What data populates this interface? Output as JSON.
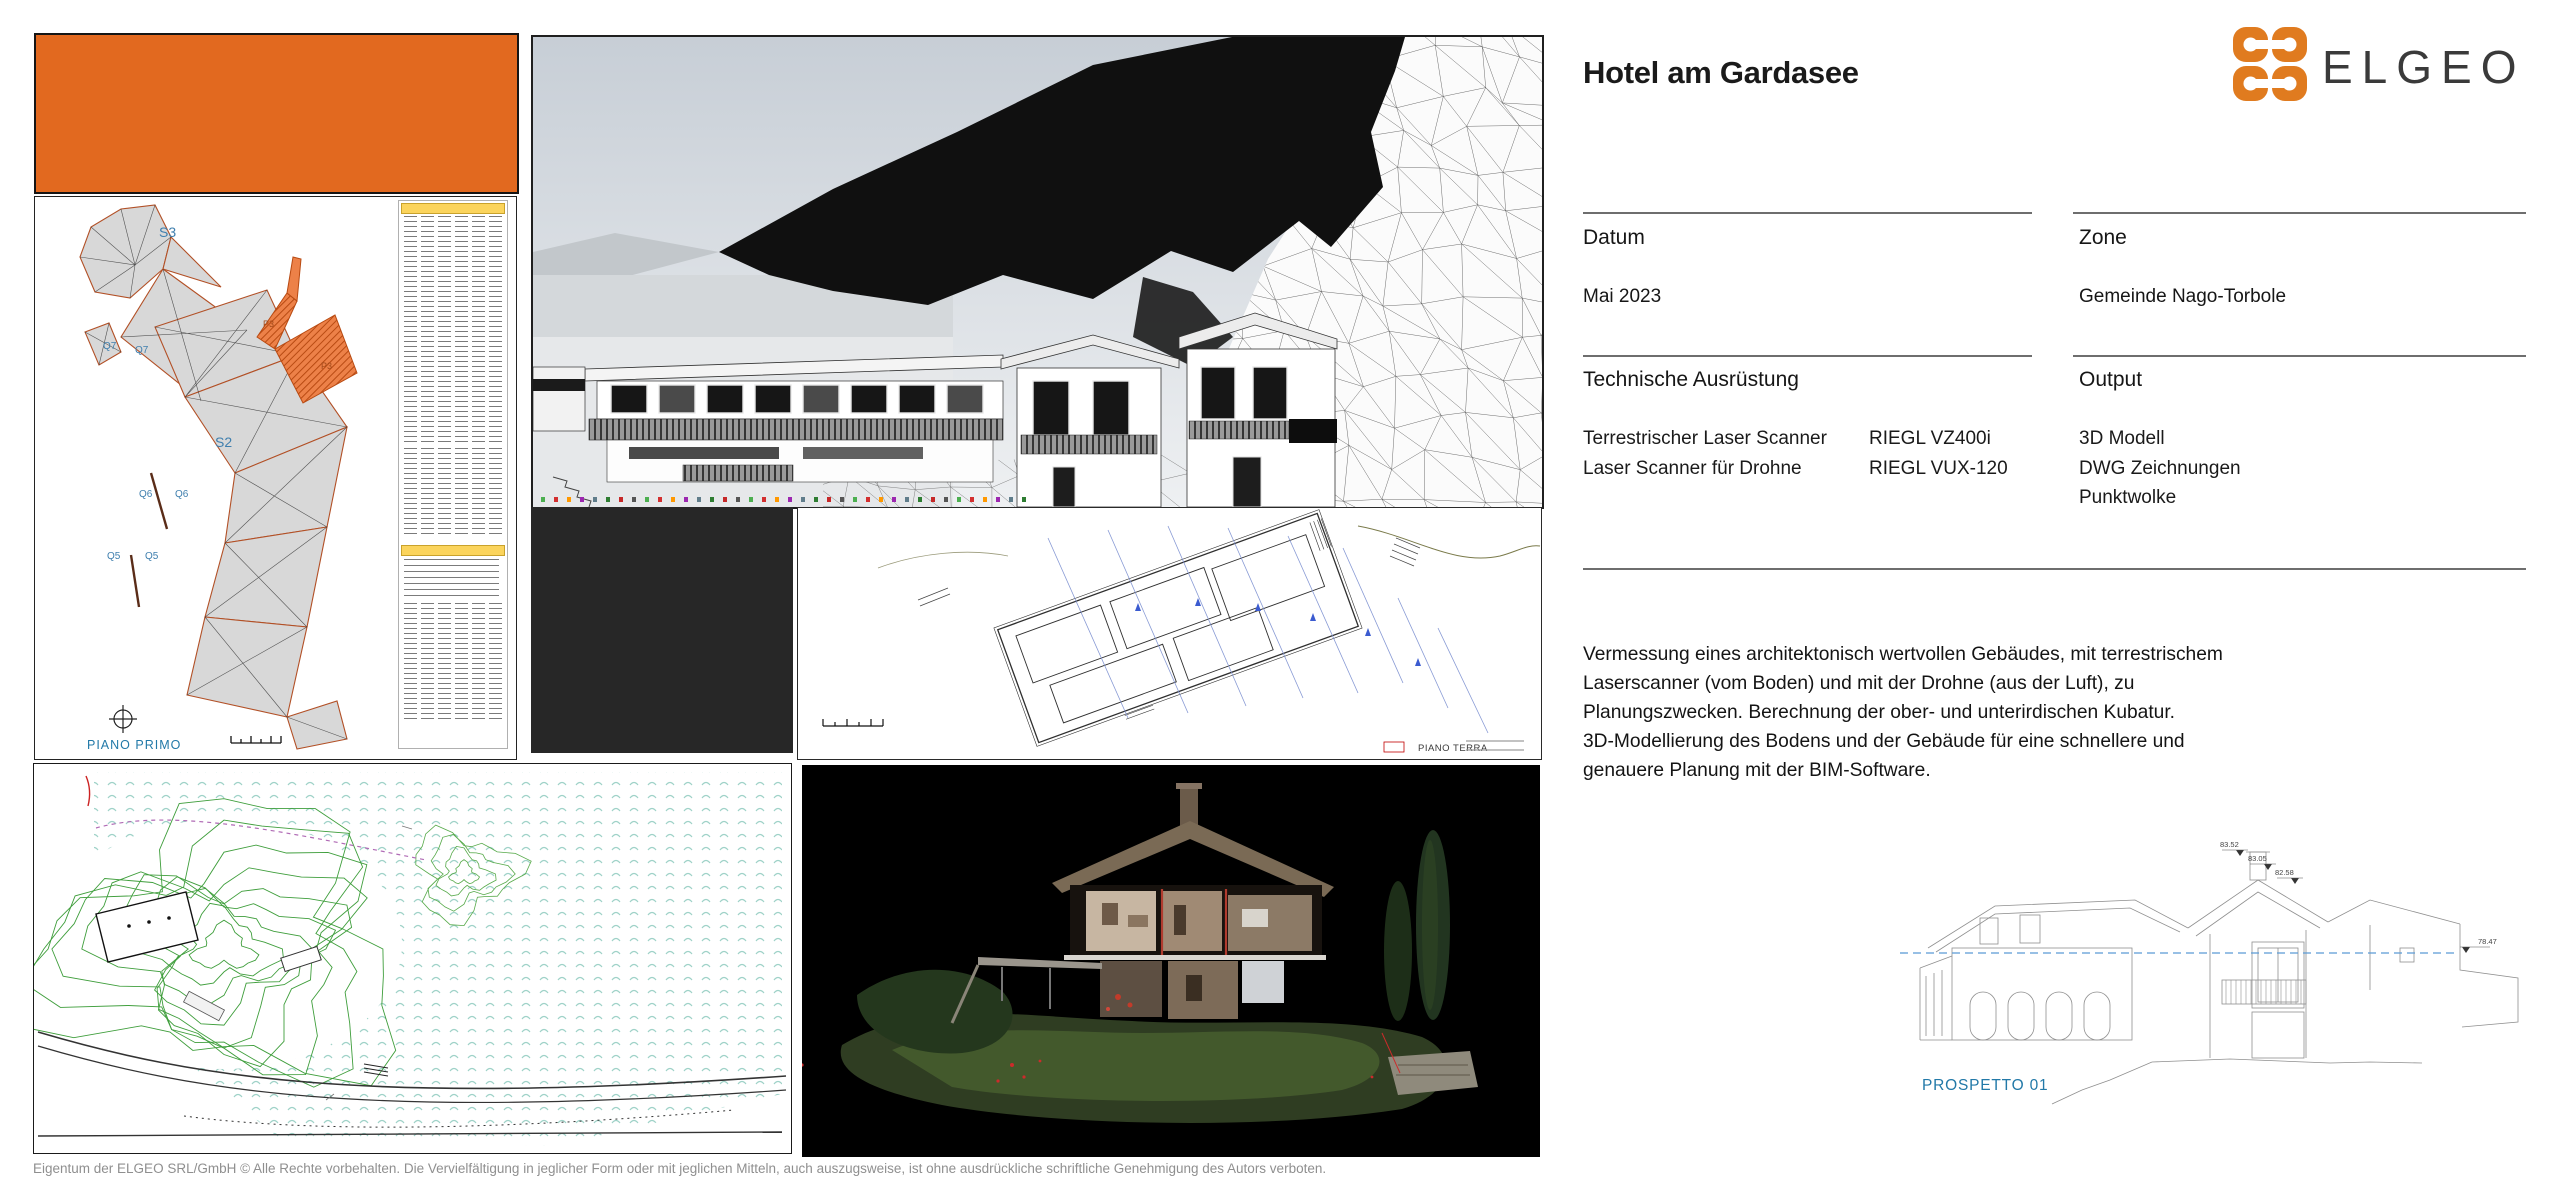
{
  "header": {
    "title": "Hotel am Gardasee"
  },
  "logo": {
    "text": "ELGEO",
    "orange": "#E07B1F",
    "dark": "#3A3A3A"
  },
  "fields": {
    "datum": {
      "label": "Datum",
      "value": "Mai 2023"
    },
    "zone": {
      "label": "Zone",
      "value": "Gemeinde Nago-Torbole"
    },
    "equipment": {
      "label": "Technische Ausrüstung",
      "items": [
        {
          "device": "Terrestrischer Laser Scanner",
          "model": "RIEGL VZ400i"
        },
        {
          "device": "Laser Scanner für Drohne",
          "model": "RIEGL VUX-120"
        }
      ]
    },
    "output": {
      "label": "Output",
      "items": [
        "3D Modell",
        "DWG Zeichnungen",
        "Punktwolke"
      ]
    }
  },
  "description": {
    "lines": [
      "Vermessung eines architektonisch wertvollen Gebäudes, mit terrestrischem",
      "Laserscanner (vom Boden) und mit der Drohne (aus der Luft), zu",
      "Planungszwecken. Berechnung der ober- und unterirdischen Kubatur.",
      "3D-Modellierung des Bodens und der Gebäude für eine schnellere und",
      "genauere Planung mit der BIM-Software."
    ]
  },
  "drawings": {
    "piano_primo": {
      "title": "PIANO PRIMO",
      "zones": {
        "s3": "S3",
        "s2": "S2",
        "q7a": "Q7",
        "q7b": "Q7",
        "q6a": "Q6",
        "q6b": "Q6",
        "q5a": "Q5",
        "q5b": "Q5",
        "p3a": "P3",
        "p3b": "P3"
      }
    },
    "piano_terra": {
      "title": "PIANO TERRA"
    },
    "prospetto": {
      "title": "PROSPETTO 01",
      "levels": [
        "83.52",
        "83.05",
        "82.58",
        "78.47"
      ]
    }
  },
  "footer": {
    "copyright": "Eigentum der ELGEO SRL/GmbH © Alle Rechte vorbehalten. Die Vervielfältigung in jeglicher Form oder mit jeglichen Mitteln, auch auszugsweise, ist ohne ausdrückliche schriftliche Genehmigung des Autors verboten."
  },
  "colors": {
    "accent_orange": "#E2691F",
    "plan_label_blue": "#2279A8",
    "contour_green": "#3F9E3C",
    "rule_gray": "#6E6E6E"
  }
}
